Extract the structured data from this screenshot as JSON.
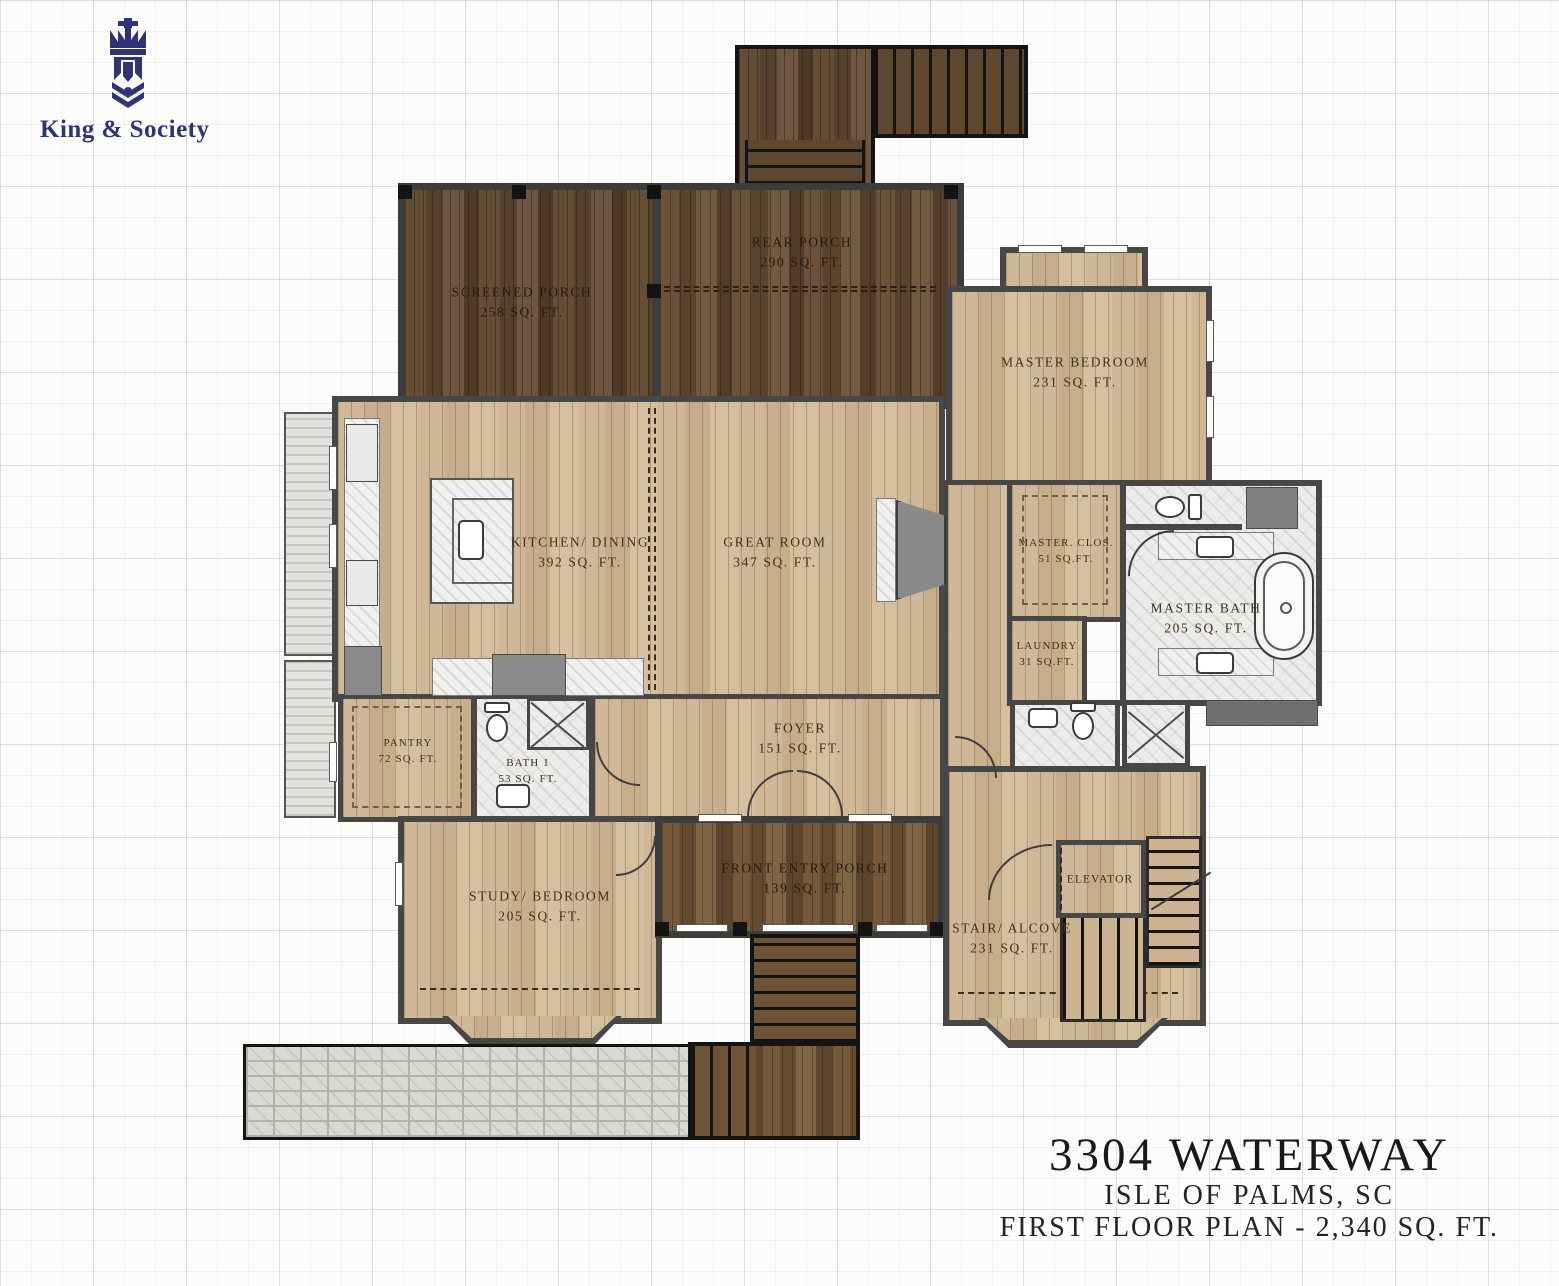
{
  "brand": {
    "name": "King & Society"
  },
  "title_block": {
    "address": "3304 WATERWAY",
    "location": "ISLE OF PALMS, SC",
    "plan_line": "FIRST FLOOR PLAN - 2,340 SQ. FT."
  },
  "rooms": {
    "screened_porch": {
      "name": "SCREENED PORCH",
      "area": "258 SQ. FT."
    },
    "rear_porch": {
      "name": "REAR PORCH",
      "area": "290 SQ. FT."
    },
    "master_bedroom": {
      "name": "MASTER BEDROOM",
      "area": "231 SQ. FT."
    },
    "kitchen_dining": {
      "name": "KITCHEN/ DINING",
      "area": "392 SQ. FT."
    },
    "great_room": {
      "name": "GREAT ROOM",
      "area": "347 SQ. FT."
    },
    "master_closet": {
      "name": "MASTER. CLOS.",
      "area": "51 SQ.FT."
    },
    "master_bath": {
      "name": "MASTER BATH",
      "area": "205 SQ. FT."
    },
    "laundry": {
      "name": "LAUNDRY",
      "area": "31 SQ.FT."
    },
    "pantry": {
      "name": "PANTRY",
      "area": "72 SQ. FT."
    },
    "bath_1": {
      "name": "BATH 1",
      "area": "53 SQ. FT."
    },
    "foyer": {
      "name": "FOYER",
      "area": "151 SQ. FT."
    },
    "front_entry_porch": {
      "name": "FRONT ENTRY PORCH",
      "area": "139 SQ. FT."
    },
    "study_bedroom": {
      "name": "STUDY/ BEDROOM",
      "area": "205 SQ. FT."
    },
    "stair_alcove": {
      "name": "STAIR/ ALCOVE",
      "area": "231 SQ. FT."
    },
    "elevator": {
      "name": "ELEVATOR"
    }
  },
  "colors": {
    "brand_navy": "#2e3476",
    "wall_gray": "#474747",
    "porch_wood": "#5d4730",
    "entry_wood": "#6e5436",
    "floor_tan": "#ccb492",
    "marble": "#ececea",
    "paver_gray": "#dadad5",
    "label_ink": "#40311d",
    "title_ink": "#191919"
  }
}
